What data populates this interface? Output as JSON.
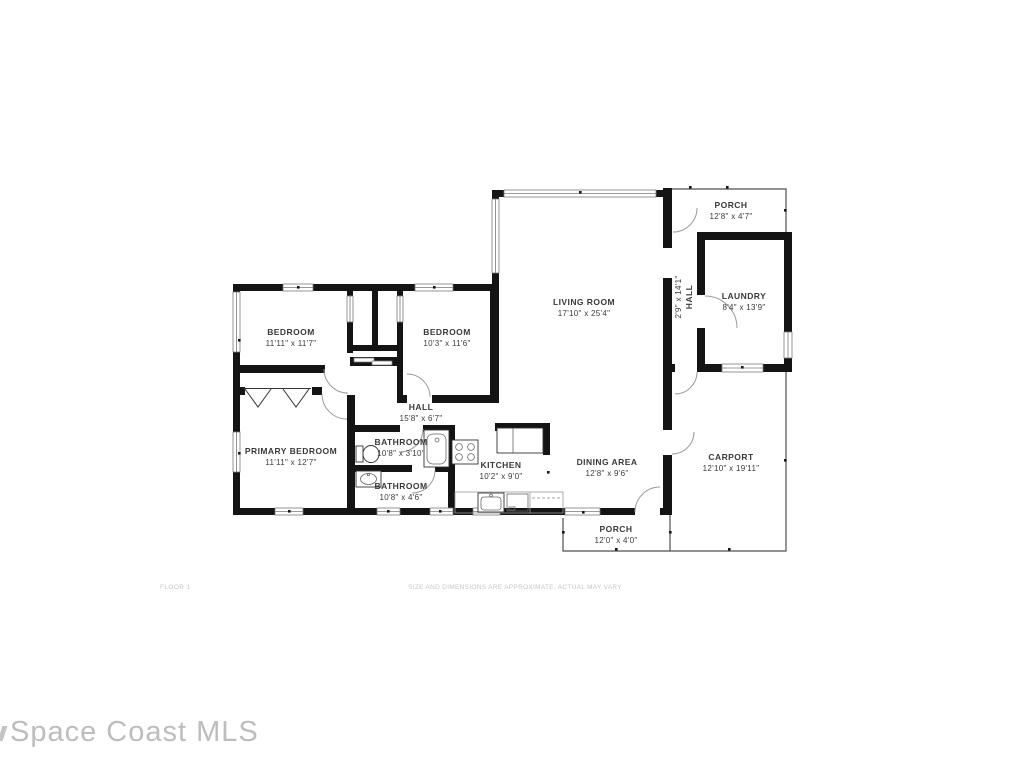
{
  "watermark": {
    "text": "Space Coast MLS"
  },
  "footer": {
    "floor_label": "FLOOR 1",
    "disclaimer": "SIZE AND DIMENSIONS ARE APPROXIMATE, ACTUAL MAY VARY"
  },
  "colors": {
    "wall": "#141414",
    "label_text": "#3a3a3a",
    "muted_text": "#c6c6c6",
    "thin_line": "#4f4f4f"
  },
  "rooms": {
    "bedroom1": {
      "name": "BEDROOM",
      "dims": "11'11\" x 11'7\""
    },
    "bedroom2": {
      "name": "BEDROOM",
      "dims": "10'3\" x 11'6\""
    },
    "living_room": {
      "name": "LIVING ROOM",
      "dims": "17'10\" x 25'4\""
    },
    "porch_top": {
      "name": "PORCH",
      "dims": "12'8\" x 4'7\""
    },
    "laundry": {
      "name": "LAUNDRY",
      "dims": "8'4\" x 13'9\""
    },
    "hall_vertical": {
      "name": "HALL",
      "dims": "2'9\" x 14'1\""
    },
    "hall": {
      "name": "HALL",
      "dims": "15'8\" x 6'7\""
    },
    "primary_bedroom": {
      "name": "PRIMARY BEDROOM",
      "dims": "11'11\" x 12'7\""
    },
    "bathroom1": {
      "name": "BATHROOM",
      "dims": "10'8\" x 3'10\""
    },
    "bathroom2": {
      "name": "BATHROOM",
      "dims": "10'8\" x 4'6\""
    },
    "kitchen": {
      "name": "KITCHEN",
      "dims": "10'2\" x 9'0\""
    },
    "dining_area": {
      "name": "DINING AREA",
      "dims": "12'8\" x 9'6\""
    },
    "carport": {
      "name": "CARPORT",
      "dims": "12'10\" x 19'11\""
    },
    "porch_bottom": {
      "name": "PORCH",
      "dims": "12'0\" x 4'0\""
    }
  }
}
